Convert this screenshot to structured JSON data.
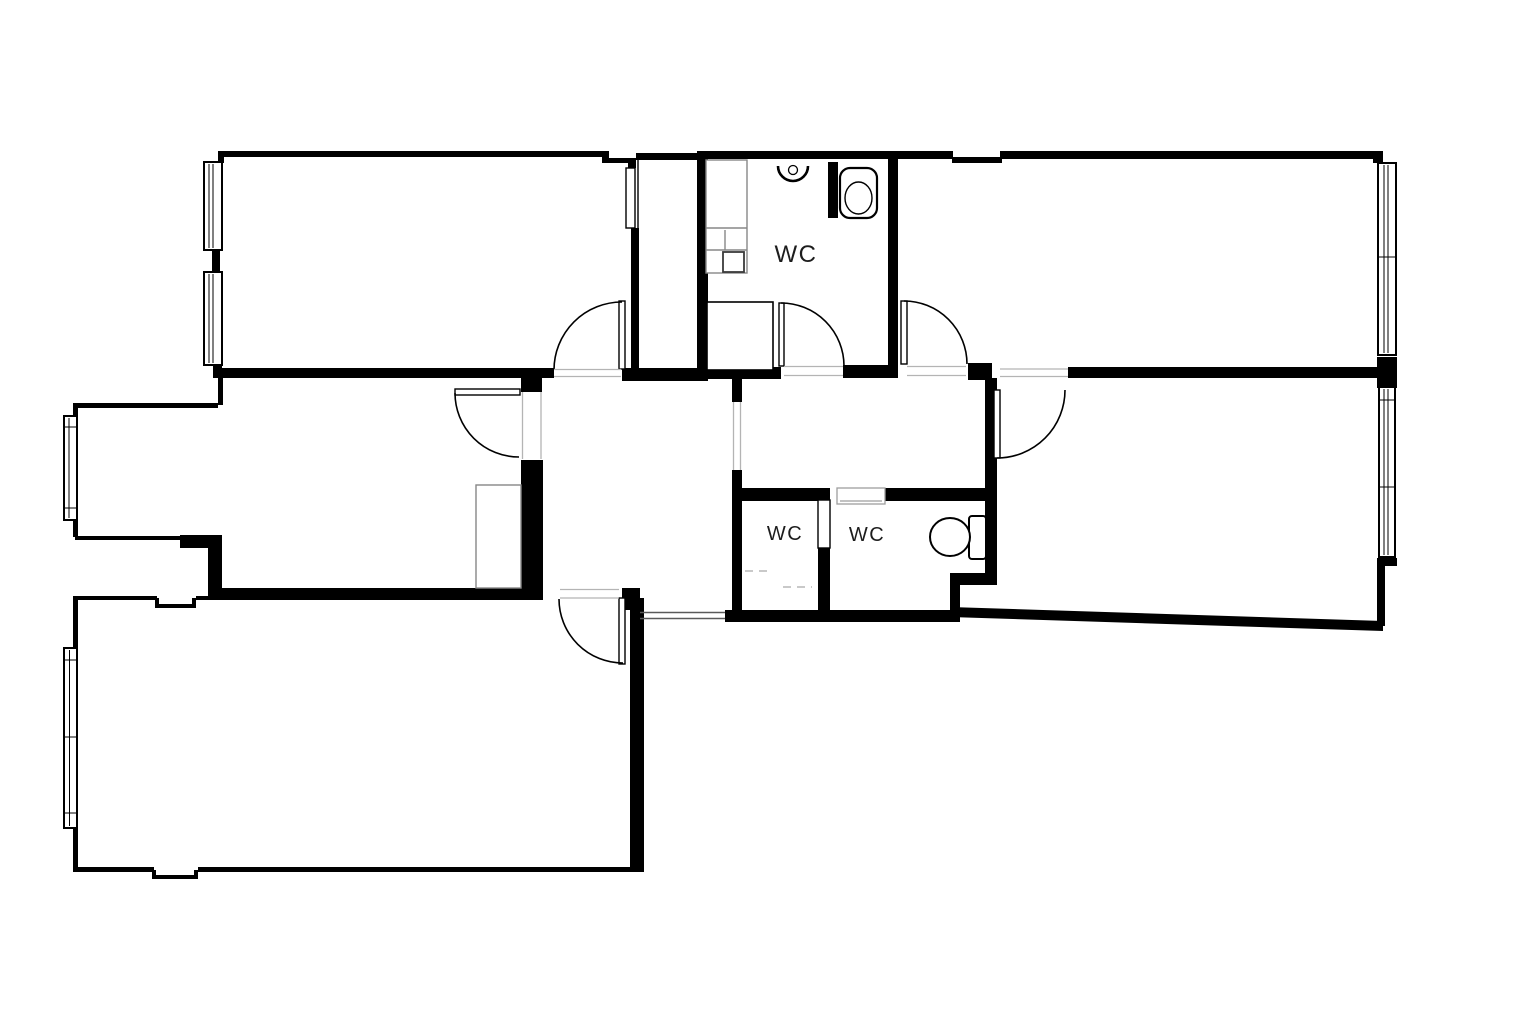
{
  "page": {
    "background": "#ffffff",
    "drawing_type": "floor-plan"
  },
  "colors": {
    "wall": "#000000",
    "line": "#000000",
    "threshold": "#b4b4b4",
    "opening_line": "#5a5a5a",
    "furniture": "#878787",
    "slider": "#9e9e9e",
    "faint": "#c9c9c9",
    "text": "#1d1d1d"
  },
  "labels": {
    "wc_top": {
      "text": "WC"
    },
    "wc_mid_left": {
      "text": "WC"
    },
    "wc_mid_right": {
      "text": "WC"
    }
  },
  "fixtures": {
    "toilet_top": "toilet-icon",
    "toilet_mid": "toilet-icon",
    "sink_top": "sink-icon",
    "shower_top": "shower-tray-icon",
    "sliding_door": "pocket-door-icon"
  }
}
